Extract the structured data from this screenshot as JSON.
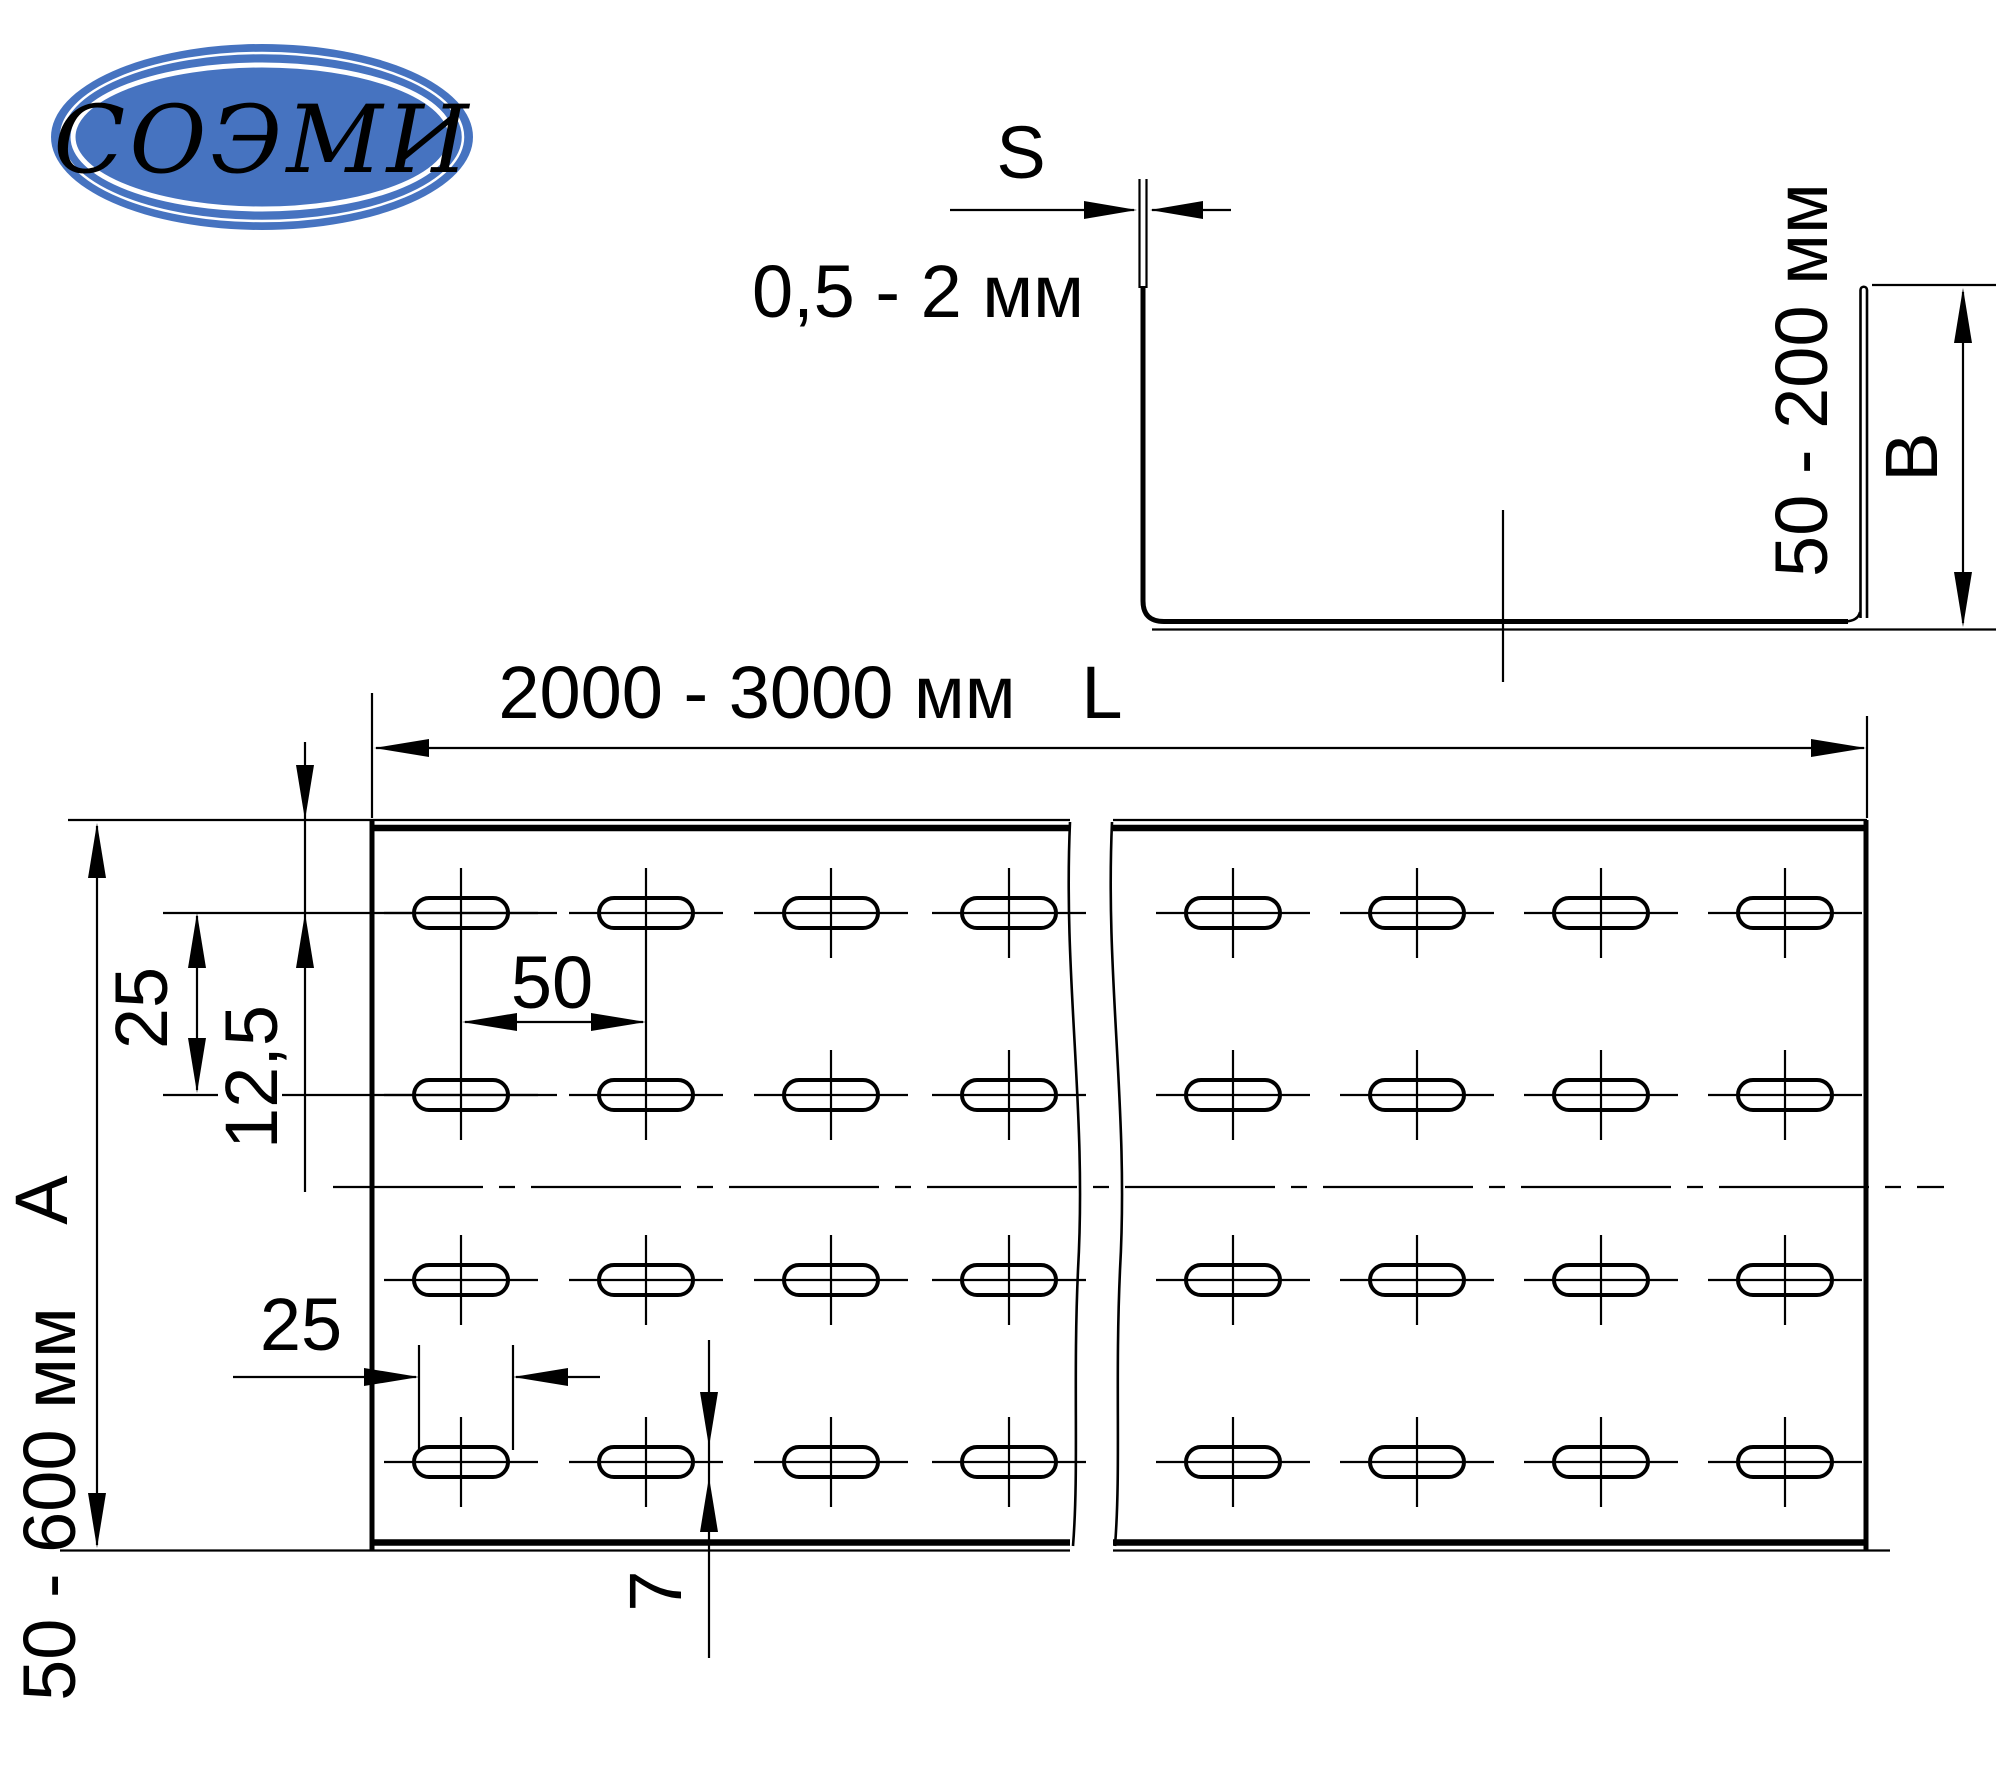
{
  "page": {
    "background": "#ffffff",
    "line_color": "#000000"
  },
  "logo": {
    "text": "СОЭМИ",
    "bg_color": "#4673c0",
    "text_color": "#ffffff"
  },
  "cross_section": {
    "thickness_label": "S",
    "thickness_range": "0,5 - 2 мм",
    "side_height_range": "50 - 200 мм",
    "side_height_label": "B"
  },
  "plan_view": {
    "length_range": "2000 - 3000 мм",
    "length_label": "L",
    "width_range": "50 - 600 мм",
    "width_label": "A",
    "hole_row_pitch": "25",
    "hole_edge_offset": "12,5",
    "hole_column_pitch": "50",
    "hole_length": "25",
    "hole_height": "7"
  }
}
